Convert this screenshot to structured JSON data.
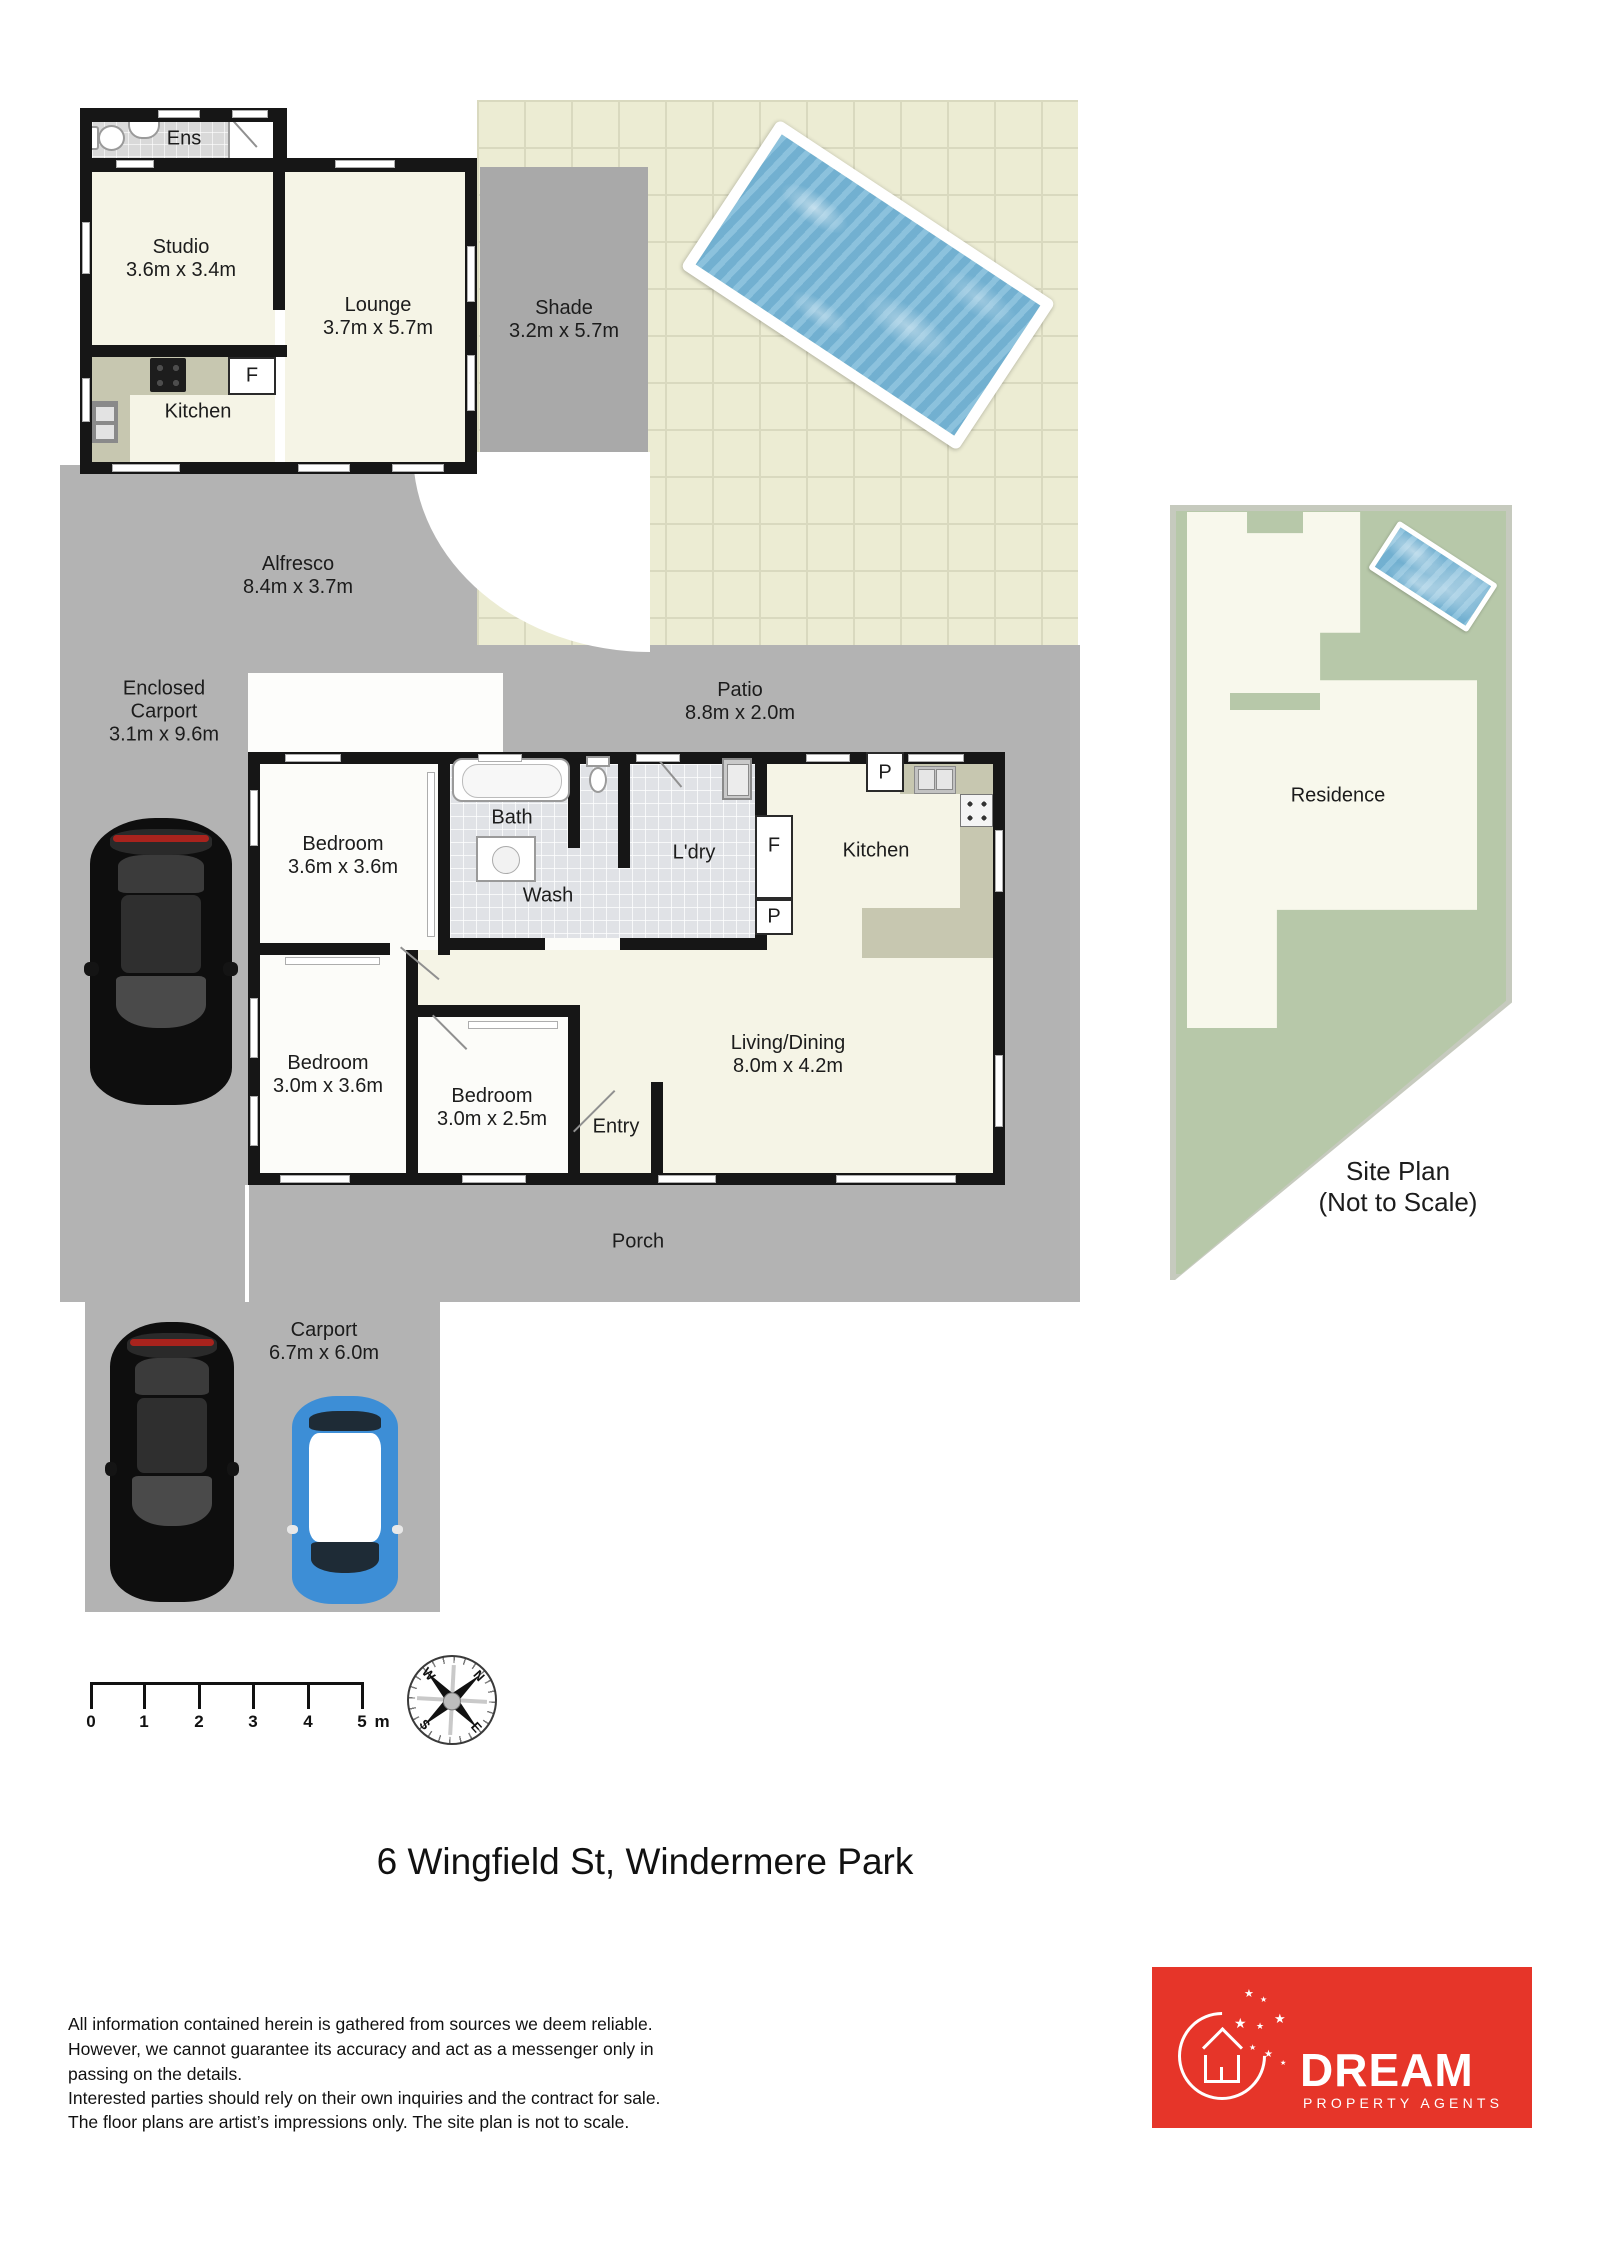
{
  "title": "6 Wingfield St, Windermere Park",
  "studio": {
    "ens": "Ens",
    "studio_label": "Studio",
    "studio_dims": "3.6m x 3.4m",
    "lounge_label": "Lounge",
    "lounge_dims": "3.7m x 5.7m",
    "kitchen": "Kitchen",
    "fridge": "F"
  },
  "outdoor": {
    "shade_label": "Shade",
    "shade_dims": "3.2m x 5.7m",
    "alfresco_label": "Alfresco",
    "alfresco_dims": "8.4m x 3.7m",
    "enclosed_carport_line1": "Enclosed",
    "enclosed_carport_line2": "Carport",
    "enclosed_carport_dims": "3.1m x 9.6m",
    "patio_label": "Patio",
    "patio_dims": "8.8m x 2.0m",
    "porch": "Porch",
    "carport_label": "Carport",
    "carport_dims": "6.7m x 6.0m"
  },
  "house": {
    "bedroom1_label": "Bedroom",
    "bedroom1_dims": "3.6m x 3.6m",
    "bedroom2_label": "Bedroom",
    "bedroom2_dims": "3.0m x 3.6m",
    "bedroom3_label": "Bedroom",
    "bedroom3_dims": "3.0m x 2.5m",
    "bath": "Bath",
    "wash": "Wash",
    "laundry": "L'dry",
    "fridge": "F",
    "pantry_top": "P",
    "pantry_bottom": "P",
    "kitchen": "Kitchen",
    "living_label": "Living/Dining",
    "living_dims": "8.0m x 4.2m",
    "entry": "Entry"
  },
  "site_plan": {
    "residence": "Residence",
    "caption_line1": "Site Plan",
    "caption_line2": "(Not to Scale)"
  },
  "scale_bar": {
    "labels": [
      "0",
      "1",
      "2",
      "3",
      "4",
      "5"
    ],
    "unit": "m"
  },
  "compass": {
    "n": "N",
    "e": "E",
    "s": "S",
    "w": "W"
  },
  "footer": {
    "disclaimer_lines": [
      "All information contained herein is gathered from sources we deem reliable.",
      "However, we cannot guarantee its accuracy and act as a messenger only in",
      "passing on the details.",
      "Interested parties should rely on their own inquiries and the contract for sale.",
      "The floor plans are artist’s impressions only. The site plan is not to scale."
    ],
    "logo": {
      "brand": "DREAM",
      "tagline": "PROPERTY AGENTS"
    }
  },
  "colors": {
    "outdoor_gray": "#b3b3b3",
    "shade_gray": "#a9a9a9",
    "tile_cream": "#ececd3",
    "floor_cream": "#f5f4e6",
    "wall": "#161616",
    "pool_water": "#7cb9d8",
    "site_lawn": "#b7c8a9",
    "residence_cream": "#f8f8ec",
    "logo_red": "#e63529"
  }
}
